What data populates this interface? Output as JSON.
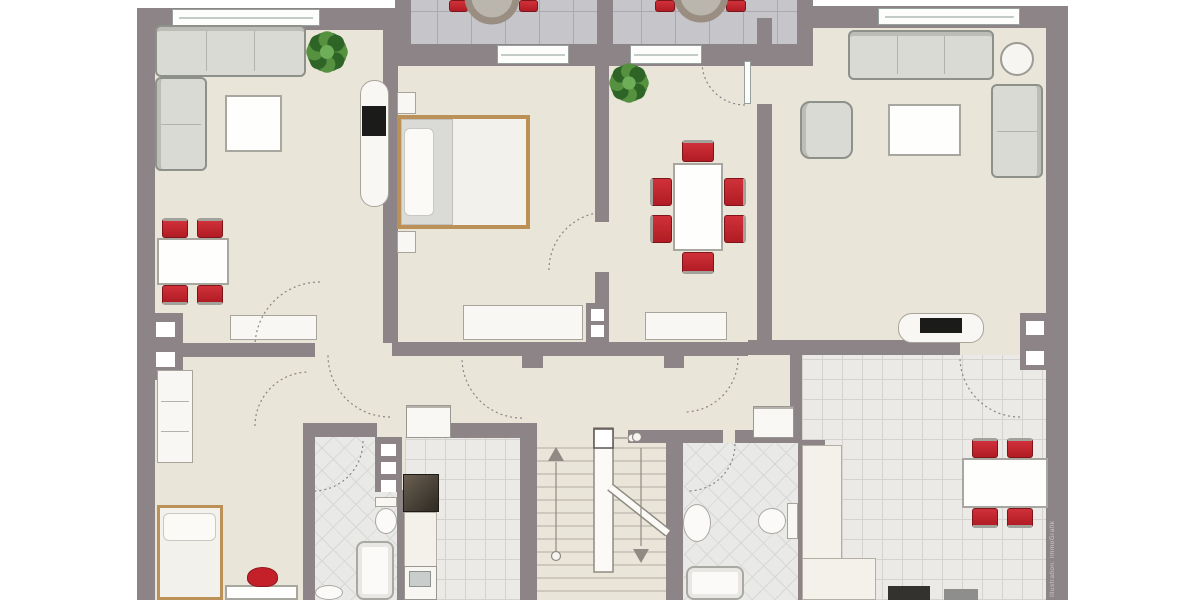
{
  "watermark": {
    "text": "Illustration: ImmoGrafik"
  },
  "palette": {
    "wall": "#8c8487",
    "floor": "#eae5d9",
    "balcony_tile": "#c6c6ca",
    "kitchen_tile": "#ebeae6",
    "bath_tile": "#e9e9e7",
    "chair_red": "#c0222a",
    "bed_wood": "#bb9157",
    "plant_green": "#417a33",
    "sofa_gray": "#d9dad4",
    "appliance_dark": "#34322f"
  },
  "plan": {
    "floors": [
      {
        "n": "floor-base",
        "k": "floor-beige",
        "x": 140,
        "y": 10,
        "w": 925,
        "h": 590
      },
      {
        "n": "balcony-floor",
        "k": "tile-balcony",
        "x": 403,
        "y": 0,
        "w": 402,
        "h": 46
      },
      {
        "n": "kitchen-left-floor",
        "k": "tile-kitchen",
        "x": 405,
        "y": 437,
        "w": 115,
        "h": 163
      },
      {
        "n": "bathroom-left-floor",
        "k": "tile-bath",
        "x": 315,
        "y": 437,
        "w": 82,
        "h": 163
      },
      {
        "n": "bathroom-right-floor",
        "k": "tile-bath",
        "x": 684,
        "y": 443,
        "w": 114,
        "h": 157
      },
      {
        "n": "kitchen-right-floor",
        "k": "tile-kitchen",
        "x": 802,
        "y": 355,
        "w": 244,
        "h": 245
      }
    ],
    "walls": [
      {
        "x": 137,
        "y": 8,
        "w": 18,
        "h": 592
      },
      {
        "x": 137,
        "y": 8,
        "w": 266,
        "h": 22
      },
      {
        "x": 395,
        "y": 0,
        "w": 16,
        "h": 66
      },
      {
        "x": 597,
        "y": 0,
        "w": 16,
        "h": 66
      },
      {
        "x": 797,
        "y": 0,
        "w": 16,
        "h": 66
      },
      {
        "x": 395,
        "y": 44,
        "w": 418,
        "h": 22
      },
      {
        "x": 810,
        "y": 6,
        "w": 258,
        "h": 22
      },
      {
        "x": 1046,
        "y": 6,
        "w": 22,
        "h": 594
      },
      {
        "x": 383,
        "y": 18,
        "w": 15,
        "h": 325
      },
      {
        "x": 595,
        "y": 44,
        "w": 14,
        "h": 178
      },
      {
        "x": 595,
        "y": 272,
        "w": 14,
        "h": 71
      },
      {
        "x": 757,
        "y": 18,
        "w": 15,
        "h": 42
      },
      {
        "x": 757,
        "y": 104,
        "w": 15,
        "h": 239
      },
      {
        "x": 148,
        "y": 343,
        "w": 167,
        "h": 14
      },
      {
        "x": 148,
        "y": 313,
        "w": 35,
        "h": 67
      },
      {
        "x": 392,
        "y": 342,
        "w": 356,
        "h": 14
      },
      {
        "x": 522,
        "y": 356,
        "w": 21,
        "h": 12
      },
      {
        "x": 664,
        "y": 356,
        "w": 20,
        "h": 12
      },
      {
        "x": 748,
        "y": 340,
        "w": 45,
        "h": 15
      },
      {
        "x": 793,
        "y": 340,
        "w": 167,
        "h": 15
      },
      {
        "x": 1020,
        "y": 313,
        "w": 31,
        "h": 57
      },
      {
        "x": 790,
        "y": 352,
        "w": 12,
        "h": 90
      },
      {
        "x": 798,
        "y": 440,
        "w": 27,
        "h": 53
      },
      {
        "x": 798,
        "y": 491,
        "w": 14,
        "h": 109
      },
      {
        "x": 520,
        "y": 423,
        "w": 17,
        "h": 177
      },
      {
        "x": 666,
        "y": 432,
        "w": 17,
        "h": 168
      },
      {
        "x": 628,
        "y": 430,
        "w": 95,
        "h": 13
      },
      {
        "x": 735,
        "y": 430,
        "w": 63,
        "h": 13
      },
      {
        "x": 303,
        "y": 423,
        "w": 12,
        "h": 177
      },
      {
        "x": 303,
        "y": 423,
        "w": 74,
        "h": 14
      },
      {
        "x": 375,
        "y": 437,
        "w": 27,
        "h": 55
      },
      {
        "x": 397,
        "y": 490,
        "w": 9,
        "h": 110
      },
      {
        "x": 450,
        "y": 423,
        "w": 71,
        "h": 15
      },
      {
        "x": 586,
        "y": 303,
        "w": 22,
        "h": 40
      }
    ],
    "wall_squares": [
      {
        "x": 156,
        "y": 322,
        "w": 19,
        "h": 15
      },
      {
        "x": 156,
        "y": 352,
        "w": 19,
        "h": 15
      },
      {
        "x": 381,
        "y": 444,
        "w": 15,
        "h": 12
      },
      {
        "x": 381,
        "y": 462,
        "w": 15,
        "h": 12
      },
      {
        "x": 381,
        "y": 480,
        "w": 15,
        "h": 12
      },
      {
        "x": 804,
        "y": 446,
        "w": 15,
        "h": 12
      },
      {
        "x": 804,
        "y": 464,
        "w": 15,
        "h": 12
      },
      {
        "x": 804,
        "y": 482,
        "w": 15,
        "h": 12
      },
      {
        "x": 1026,
        "y": 321,
        "w": 18,
        "h": 14
      },
      {
        "x": 1026,
        "y": 351,
        "w": 18,
        "h": 14
      },
      {
        "x": 591,
        "y": 309,
        "w": 13,
        "h": 12
      },
      {
        "x": 591,
        "y": 325,
        "w": 13,
        "h": 12
      }
    ],
    "windows": [
      {
        "n": "window-top-left",
        "x": 172,
        "y": 9,
        "w": 148,
        "h": 17
      },
      {
        "n": "window-top-right",
        "x": 878,
        "y": 8,
        "w": 142,
        "h": 17
      },
      {
        "n": "balcony-door-left",
        "x": 497,
        "y": 45,
        "w": 72,
        "h": 19
      },
      {
        "n": "balcony-door-right",
        "x": 630,
        "y": 45,
        "w": 72,
        "h": 19
      }
    ],
    "door_leaves": [
      {
        "n": "door-leaf-dining",
        "x": 744,
        "y": 61,
        "w": 7,
        "h": 43
      }
    ],
    "furniture": [
      {
        "n": "corner-sofa-top",
        "k": "sofa",
        "x": 155,
        "y": 25,
        "w": 151,
        "h": 52,
        "bk": "top",
        "dv": [
          {
            "o": "v",
            "p": 33
          },
          {
            "o": "v",
            "p": 66
          }
        ]
      },
      {
        "n": "corner-sofa-side",
        "k": "sofa",
        "x": 155,
        "y": 77,
        "w": 52,
        "h": 94,
        "bk": "left",
        "dv": [
          {
            "o": "h",
            "p": 50
          }
        ]
      },
      {
        "n": "coffee-table-left",
        "k": "table",
        "x": 225,
        "y": 95,
        "w": 57,
        "h": 57
      },
      {
        "n": "dining-table-left",
        "k": "table",
        "x": 157,
        "y": 238,
        "w": 72,
        "h": 47
      },
      {
        "n": "chair-red",
        "k": "chair",
        "x": 162,
        "y": 218,
        "w": 26,
        "h": 20,
        "bk": "top"
      },
      {
        "n": "chair-red",
        "k": "chair",
        "x": 197,
        "y": 218,
        "w": 26,
        "h": 20,
        "bk": "top"
      },
      {
        "n": "chair-red",
        "k": "chair",
        "x": 162,
        "y": 285,
        "w": 26,
        "h": 20,
        "bk": "bottom"
      },
      {
        "n": "chair-red",
        "k": "chair",
        "x": 197,
        "y": 285,
        "w": 26,
        "h": 20,
        "bk": "bottom"
      },
      {
        "n": "sideboard-left",
        "k": "cabinet",
        "x": 230,
        "y": 315,
        "w": 87,
        "h": 25
      },
      {
        "n": "tv-cabinet-left",
        "k": "cabinet-round",
        "x": 360,
        "y": 80,
        "w": 29,
        "h": 127
      },
      {
        "n": "tv-left",
        "k": "tv",
        "x": 362,
        "y": 106,
        "w": 24,
        "h": 30
      },
      {
        "n": "nightstand-top",
        "k": "cabinet",
        "x": 397,
        "y": 92,
        "w": 19,
        "h": 22
      },
      {
        "n": "nightstand-bottom",
        "k": "cabinet",
        "x": 397,
        "y": 231,
        "w": 19,
        "h": 22
      },
      {
        "n": "double-bed",
        "k": "bed",
        "x": 397,
        "y": 115,
        "w": 133,
        "h": 114
      },
      {
        "n": "bed-blanket",
        "k": "blanket",
        "x": 401,
        "y": 119,
        "w": 52,
        "h": 106
      },
      {
        "n": "bed-pillow",
        "k": "pillow",
        "x": 404,
        "y": 128,
        "w": 30,
        "h": 88
      },
      {
        "n": "bedroom-dresser",
        "k": "cabinet",
        "x": 463,
        "y": 305,
        "w": 120,
        "h": 35
      },
      {
        "n": "dining-table-center",
        "k": "table",
        "x": 673,
        "y": 163,
        "w": 50,
        "h": 88
      },
      {
        "n": "chair-red",
        "k": "chair",
        "x": 650,
        "y": 178,
        "w": 22,
        "h": 28,
        "bk": "left"
      },
      {
        "n": "chair-red",
        "k": "chair",
        "x": 650,
        "y": 215,
        "w": 22,
        "h": 28,
        "bk": "left"
      },
      {
        "n": "chair-red",
        "k": "chair",
        "x": 724,
        "y": 178,
        "w": 22,
        "h": 28,
        "bk": "right"
      },
      {
        "n": "chair-red",
        "k": "chair",
        "x": 724,
        "y": 215,
        "w": 22,
        "h": 28,
        "bk": "right"
      },
      {
        "n": "chair-red",
        "k": "chair",
        "x": 682,
        "y": 140,
        "w": 32,
        "h": 22,
        "bk": "top"
      },
      {
        "n": "chair-red",
        "k": "chair",
        "x": 682,
        "y": 252,
        "w": 32,
        "h": 22,
        "bk": "bottom"
      },
      {
        "n": "sideboard-dining",
        "k": "cabinet",
        "x": 645,
        "y": 312,
        "w": 82,
        "h": 28
      },
      {
        "n": "sofa-right",
        "k": "sofa",
        "x": 848,
        "y": 30,
        "w": 146,
        "h": 50,
        "bk": "top",
        "dv": [
          {
            "o": "v",
            "p": 33
          },
          {
            "o": "v",
            "p": 66
          }
        ]
      },
      {
        "n": "side-table-round",
        "k": "circle-table",
        "x": 1000,
        "y": 42,
        "w": 34,
        "h": 34
      },
      {
        "n": "loveseat-right",
        "k": "sofa",
        "x": 991,
        "y": 84,
        "w": 52,
        "h": 94,
        "bk": "right",
        "dv": [
          {
            "o": "h",
            "p": 50
          }
        ]
      },
      {
        "n": "armchair",
        "k": "sofa",
        "x": 800,
        "y": 101,
        "w": 53,
        "h": 58,
        "bk": "left",
        "r": 10
      },
      {
        "n": "coffee-table-right",
        "k": "table",
        "x": 888,
        "y": 104,
        "w": 73,
        "h": 52
      },
      {
        "n": "tv-stand-right",
        "k": "cabinet-round",
        "x": 898,
        "y": 313,
        "w": 86,
        "h": 30
      },
      {
        "n": "tv-right",
        "k": "tv",
        "x": 920,
        "y": 318,
        "w": 42,
        "h": 15
      },
      {
        "n": "counter-right-tall",
        "k": "counter",
        "x": 802,
        "y": 445,
        "w": 40,
        "h": 155
      },
      {
        "n": "counter-right-low",
        "k": "counter",
        "x": 802,
        "y": 558,
        "w": 74,
        "h": 42
      },
      {
        "n": "oven-dark",
        "k": "dark",
        "x": 888,
        "y": 586,
        "w": 42,
        "h": 14
      },
      {
        "n": "appliance-gray",
        "k": "grayapp",
        "x": 944,
        "y": 589,
        "w": 34,
        "h": 11
      },
      {
        "n": "kitchen-table-right",
        "k": "table",
        "x": 962,
        "y": 458,
        "w": 86,
        "h": 50
      },
      {
        "n": "chair-red",
        "k": "chair",
        "x": 972,
        "y": 438,
        "w": 26,
        "h": 20,
        "bk": "top"
      },
      {
        "n": "chair-red",
        "k": "chair",
        "x": 1007,
        "y": 438,
        "w": 26,
        "h": 20,
        "bk": "top"
      },
      {
        "n": "chair-red",
        "k": "chair",
        "x": 972,
        "y": 508,
        "w": 26,
        "h": 20,
        "bk": "bottom"
      },
      {
        "n": "chair-red",
        "k": "chair",
        "x": 1007,
        "y": 508,
        "w": 26,
        "h": 20,
        "bk": "bottom"
      },
      {
        "n": "washing-machine-right",
        "k": "washer",
        "x": 753,
        "y": 406,
        "w": 41,
        "h": 32
      },
      {
        "n": "sink-bath-right",
        "k": "sink",
        "x": 683,
        "y": 504,
        "w": 28,
        "h": 38
      },
      {
        "n": "toilet-right-bowl",
        "k": "toilet",
        "x": 758,
        "y": 508,
        "w": 28,
        "h": 26
      },
      {
        "n": "toilet-right-tank",
        "k": "cabinet",
        "x": 787,
        "y": 503,
        "w": 11,
        "h": 36
      },
      {
        "n": "shower-right",
        "k": "tub",
        "x": 686,
        "y": 566,
        "w": 58,
        "h": 34
      },
      {
        "n": "tall-cabinet",
        "k": "cabinet",
        "x": 157,
        "y": 370,
        "w": 36,
        "h": 93,
        "dv": [
          {
            "o": "h",
            "p": 33
          },
          {
            "o": "h",
            "p": 66
          }
        ]
      },
      {
        "n": "single-bed",
        "k": "bed bed-single",
        "x": 157,
        "y": 505,
        "w": 66,
        "h": 95
      },
      {
        "n": "single-bed-pillow",
        "k": "pillow",
        "x": 163,
        "y": 513,
        "w": 53,
        "h": 28
      },
      {
        "n": "desk",
        "k": "table",
        "x": 225,
        "y": 585,
        "w": 73,
        "h": 15
      },
      {
        "n": "red-kettle",
        "k": "kettle",
        "x": 247,
        "y": 567,
        "w": 31,
        "h": 20
      },
      {
        "n": "toilet-left-tank",
        "k": "cabinet",
        "x": 375,
        "y": 497,
        "w": 22,
        "h": 10
      },
      {
        "n": "toilet-left-bowl",
        "k": "toilet",
        "x": 375,
        "y": 508,
        "w": 22,
        "h": 26
      },
      {
        "n": "bathtub-left",
        "k": "tub",
        "x": 356,
        "y": 541,
        "w": 38,
        "h": 59
      },
      {
        "n": "sink-bath-left",
        "k": "sink",
        "x": 315,
        "y": 585,
        "w": 28,
        "h": 15
      },
      {
        "n": "washing-machine-left",
        "k": "washer",
        "x": 406,
        "y": 405,
        "w": 45,
        "h": 33
      },
      {
        "n": "stove-left",
        "k": "stove",
        "x": 403,
        "y": 474,
        "w": 36,
        "h": 38
      },
      {
        "n": "counter-left",
        "k": "counter",
        "x": 404,
        "y": 512,
        "w": 33,
        "h": 56
      },
      {
        "n": "sink-unit-left",
        "k": "sinkk",
        "x": 404,
        "y": 566,
        "w": 33,
        "h": 34
      },
      {
        "n": "sink-basin-left",
        "k": "basin",
        "x": 409,
        "y": 571,
        "w": 22,
        "h": 16
      },
      {
        "n": "balcony-chair-red",
        "k": "chair",
        "x": 449,
        "y": 0,
        "w": 19,
        "h": 12
      },
      {
        "n": "balcony-chair-red",
        "k": "chair",
        "x": 519,
        "y": 0,
        "w": 19,
        "h": 12
      },
      {
        "n": "balcony-chair-red",
        "k": "chair",
        "x": 655,
        "y": 0,
        "w": 20,
        "h": 12
      },
      {
        "n": "balcony-chair-red",
        "k": "chair",
        "x": 726,
        "y": 0,
        "w": 20,
        "h": 12
      }
    ],
    "door_arcs": [
      {
        "cx": 320,
        "cy": 347,
        "r": 65,
        "a0": 180,
        "a1": 270
      },
      {
        "cx": 390,
        "cy": 355,
        "r": 62,
        "a0": 90,
        "a1": 180
      },
      {
        "cx": 522,
        "cy": 358,
        "r": 60,
        "a0": 90,
        "a1": 180
      },
      {
        "cx": 684,
        "cy": 358,
        "r": 54,
        "a0": 0,
        "a1": 90
      },
      {
        "cx": 607,
        "cy": 270,
        "r": 58,
        "a0": 180,
        "a1": 270
      },
      {
        "cx": 745,
        "cy": 62,
        "r": 43,
        "a0": 90,
        "a1": 180
      },
      {
        "cx": 313,
        "cy": 441,
        "r": 50,
        "a0": 0,
        "a1": 90
      },
      {
        "cx": 688,
        "cy": 444,
        "r": 47,
        "a0": 0,
        "a1": 90
      },
      {
        "cx": 1020,
        "cy": 357,
        "r": 60,
        "a0": 90,
        "a1": 180
      },
      {
        "cx": 309,
        "cy": 426,
        "r": 54,
        "a0": 180,
        "a1": 270
      }
    ],
    "balcony_tables": [
      {
        "cx": 492,
        "cy": -3,
        "r": 24
      },
      {
        "cx": 701,
        "cy": -5,
        "r": 24
      }
    ],
    "plants": [
      {
        "n": "plant-living-left",
        "cx": 327,
        "cy": 52,
        "r": 20
      },
      {
        "n": "plant-dining",
        "cx": 629,
        "cy": 83,
        "r": 19
      }
    ],
    "stairs": {
      "left": 537,
      "right": 666,
      "top": 448,
      "bottom": 598,
      "step": 13,
      "stringer": {
        "x": 594,
        "y": 428,
        "w": 19,
        "h": 144
      },
      "post": {
        "x": 594,
        "y": 429,
        "w": 19,
        "h": 19
      },
      "diagonal": [
        610,
        487,
        668,
        533
      ],
      "up": {
        "x": 556,
        "y1": 462,
        "y2": 552,
        "circle": [
          556,
          556
        ],
        "tip": [
          556,
          447
        ]
      },
      "down": {
        "x": 641,
        "y1": 448,
        "y2": 546,
        "circle": [
          637,
          437
        ],
        "tip": [
          641,
          563
        ]
      },
      "rail": {
        "x1": 613,
        "y1": 438,
        "x2": 627,
        "y2": 438,
        "circle": [
          632,
          438
        ]
      }
    }
  }
}
